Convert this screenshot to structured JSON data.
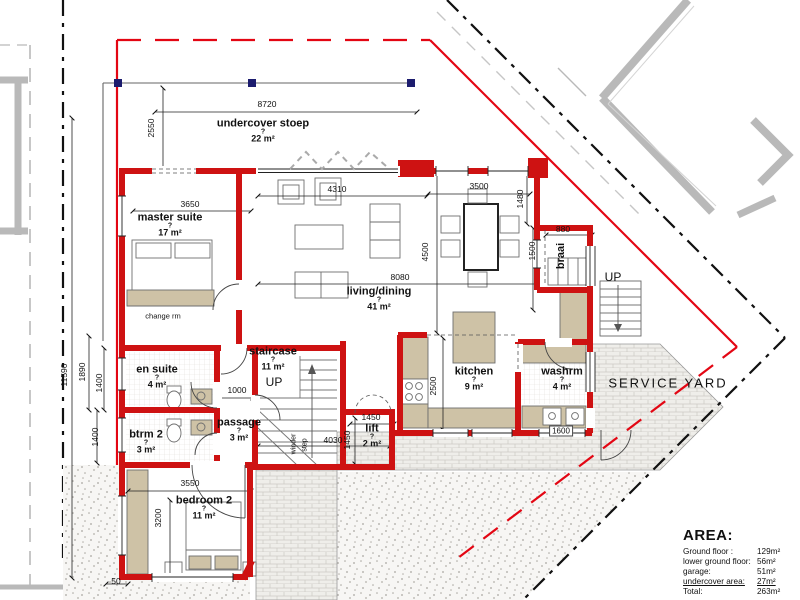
{
  "colors": {
    "wall": "#ce1212",
    "boundary_red": "#e30613",
    "beige": "#cec2a6",
    "navy": "#1c1c6e",
    "neighbor_gray": "#b9b9b9"
  },
  "labels": {
    "rooms": [
      {
        "id": "undercover-stoep",
        "name": "undercover stoep",
        "q": "?",
        "area": "22 m²",
        "x": 263,
        "y": 131,
        "rot": 0
      },
      {
        "id": "master-suite",
        "name": "master suite",
        "q": "?",
        "area": "17 m²",
        "x": 170,
        "y": 225,
        "rot": 0
      },
      {
        "id": "living-dining",
        "name": "living/dining",
        "q": "?",
        "area": "41 m²",
        "x": 379,
        "y": 299,
        "rot": 0
      },
      {
        "id": "braai",
        "name": "braai",
        "x": 561,
        "y": 256,
        "rot": 1
      },
      {
        "id": "en-suite",
        "name": "en suite",
        "q": "?",
        "area": "4 m²",
        "x": 157,
        "y": 377,
        "rot": 0
      },
      {
        "id": "staircase",
        "name": "staircase",
        "q": "?",
        "area": "11 m²",
        "x": 273,
        "y": 359,
        "rot": 0
      },
      {
        "id": "passage",
        "name": "passage",
        "q": "?",
        "area": "3 m²",
        "x": 239,
        "y": 430,
        "rot": 0
      },
      {
        "id": "btrm-2",
        "name": "btrm 2",
        "q": "?",
        "area": "3 m²",
        "x": 146,
        "y": 442,
        "rot": 0
      },
      {
        "id": "kitchen",
        "name": "kitchen",
        "q": "?",
        "area": "9 m²",
        "x": 474,
        "y": 379,
        "rot": 0
      },
      {
        "id": "washrm",
        "name": "washrm",
        "q": "?",
        "area": "4 m²",
        "x": 562,
        "y": 379,
        "rot": 0
      },
      {
        "id": "lift",
        "name": "lift",
        "q": "?",
        "area": "2 m²",
        "x": 372,
        "y": 436,
        "rot": 0
      },
      {
        "id": "bedroom-2",
        "name": "bedroom 2",
        "q": "?",
        "area": "11 m²",
        "x": 204,
        "y": 508,
        "rot": 0
      }
    ],
    "plain": [
      {
        "id": "change-rm",
        "text": "change rm",
        "x": 163,
        "y": 316,
        "size": 7.5,
        "rot": 0,
        "ls": 0,
        "bold": 0
      },
      {
        "id": "service-yard",
        "text": "SERVICE YARD",
        "x": 668,
        "y": 383,
        "size": 13,
        "rot": 0,
        "ls": 2,
        "bold": 0
      },
      {
        "id": "up-staircase",
        "text": "UP",
        "x": 274,
        "y": 382,
        "size": 12,
        "rot": 0,
        "ls": 0,
        "bold": 0
      },
      {
        "id": "up-external",
        "text": "UP",
        "x": 613,
        "y": 277,
        "size": 12,
        "rot": 0,
        "ls": 0,
        "bold": 0
      },
      {
        "id": "winder",
        "text": "winder",
        "x": 294,
        "y": 444,
        "size": 7,
        "rot": 1,
        "ls": 0,
        "bold": 0
      },
      {
        "id": "step",
        "text": "step",
        "x": 305,
        "y": 445,
        "size": 7,
        "rot": 1,
        "ls": 0,
        "bold": 0
      }
    ],
    "dims": [
      {
        "t": "8720",
        "x": 267,
        "y": 104,
        "rot": 0
      },
      {
        "t": "2550",
        "x": 151,
        "y": 128,
        "rot": 1
      },
      {
        "t": "3650",
        "x": 190,
        "y": 204,
        "rot": 0
      },
      {
        "t": "4310",
        "x": 337,
        "y": 189,
        "rot": 0
      },
      {
        "t": "3500",
        "x": 479,
        "y": 186,
        "rot": 0
      },
      {
        "t": "1480",
        "x": 520,
        "y": 199,
        "rot": 1
      },
      {
        "t": "880",
        "x": 563,
        "y": 229,
        "rot": 0
      },
      {
        "t": "1500",
        "x": 532,
        "y": 251,
        "rot": 1
      },
      {
        "t": "4500",
        "x": 425,
        "y": 252,
        "rot": 1
      },
      {
        "t": "8080",
        "x": 400,
        "y": 277,
        "rot": 0
      },
      {
        "t": "11590",
        "x": 64,
        "y": 375,
        "rot": 1
      },
      {
        "t": "1890",
        "x": 82,
        "y": 372,
        "rot": 1
      },
      {
        "t": "1400",
        "x": 99,
        "y": 383,
        "rot": 1
      },
      {
        "t": "1400",
        "x": 95,
        "y": 437,
        "rot": 1
      },
      {
        "t": "1000",
        "x": 237,
        "y": 390,
        "rot": 0
      },
      {
        "t": "2500",
        "x": 433,
        "y": 386,
        "rot": 1
      },
      {
        "t": "1450",
        "x": 371,
        "y": 417,
        "rot": 0
      },
      {
        "t": "1450",
        "x": 347,
        "y": 440,
        "rot": 1
      },
      {
        "t": "4030",
        "x": 333,
        "y": 440,
        "rot": 0
      },
      {
        "t": "3550",
        "x": 190,
        "y": 483,
        "rot": 0
      },
      {
        "t": "3200",
        "x": 158,
        "y": 518,
        "rot": 1
      },
      {
        "t": "50",
        "x": 116,
        "y": 581,
        "rot": 0
      },
      {
        "t": "1600",
        "x": 561,
        "y": 431,
        "rot": 0,
        "boxed": 1
      }
    ]
  },
  "area_table": {
    "heading": "AREA:",
    "rows": [
      {
        "label": "Ground floor :",
        "value": "129m²",
        "underline": 0
      },
      {
        "label": "lower ground floor:",
        "value": "56m²",
        "underline": 0
      },
      {
        "label": "garage:",
        "value": "51m²",
        "underline": 0
      },
      {
        "label": "undercover area:",
        "value": "27m²",
        "underline": 1
      },
      {
        "label": "Total:",
        "value": "263m²",
        "underline": 0
      }
    ]
  }
}
